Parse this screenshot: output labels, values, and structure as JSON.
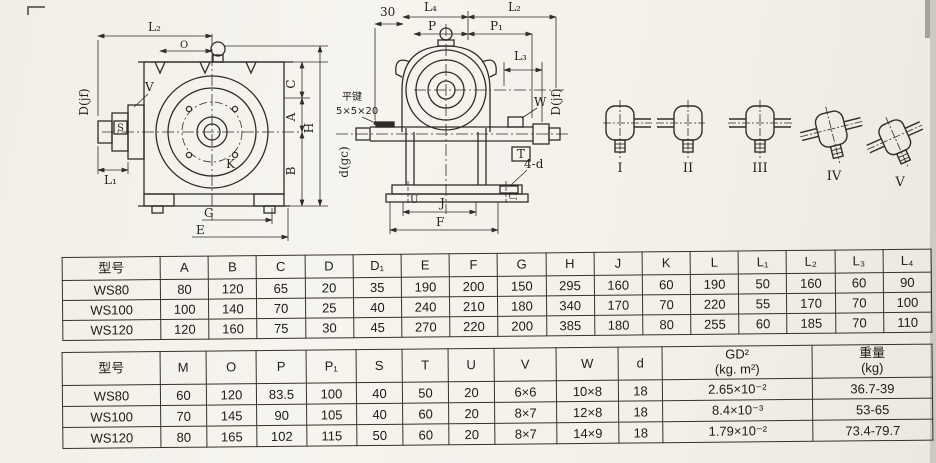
{
  "page": {
    "background": "#f4f2ec",
    "ink": "#2a2823"
  },
  "drawings": {
    "front_view": {
      "labels": {
        "L2": "L₂",
        "O": "O",
        "Djf": "D(jf)",
        "V": "V",
        "S": "S",
        "L1": "L₁",
        "K": "K",
        "C": "C",
        "A": "A",
        "B": "B",
        "H": "H",
        "G": "G",
        "E": "E"
      }
    },
    "side_view": {
      "labels": {
        "dim30": "30",
        "L4": "L₄",
        "L2": "L₂",
        "P": "P",
        "P1": "P₁",
        "L3": "L₃",
        "key_line1": "平键",
        "key_line2": "5×5×20",
        "dgc": "d(gc)",
        "W": "W",
        "Djf": "D(jf)",
        "T": "T",
        "four_d": "4-d",
        "U": "U",
        "J": "J",
        "F": "F"
      }
    },
    "shaft_arrangements": {
      "labels": [
        "I",
        "II",
        "III",
        "IV",
        "V"
      ]
    }
  },
  "tables": [
    {
      "columns": [
        "型号",
        "A",
        "B",
        "C",
        "D",
        "D₁",
        "E",
        "F",
        "G",
        "H",
        "J",
        "K",
        "L",
        "L₁",
        "L₂",
        "L₃",
        "L₄"
      ],
      "rows": [
        [
          "WS80",
          "80",
          "120",
          "65",
          "20",
          "35",
          "190",
          "200",
          "150",
          "295",
          "160",
          "60",
          "190",
          "50",
          "160",
          "60",
          "90"
        ],
        [
          "WS100",
          "100",
          "140",
          "70",
          "25",
          "40",
          "240",
          "210",
          "180",
          "340",
          "170",
          "70",
          "220",
          "55",
          "170",
          "70",
          "100"
        ],
        [
          "WS120",
          "120",
          "160",
          "75",
          "30",
          "45",
          "270",
          "220",
          "200",
          "385",
          "180",
          "80",
          "255",
          "60",
          "185",
          "70",
          "110"
        ]
      ]
    },
    {
      "columns": [
        "型号",
        "M",
        "O",
        "P",
        "P₁",
        "S",
        "T",
        "U",
        "V",
        "W",
        "d",
        "GD²\n(kg. m²)",
        "重量\n(kg)"
      ],
      "rows": [
        [
          "WS80",
          "60",
          "120",
          "83.5",
          "100",
          "40",
          "50",
          "20",
          "6×6",
          "10×8",
          "18",
          "2.65×10⁻²",
          "36.7-39"
        ],
        [
          "WS100",
          "70",
          "145",
          "90",
          "105",
          "40",
          "60",
          "20",
          "8×7",
          "12×8",
          "18",
          "8.4×10⁻³",
          "53-65"
        ],
        [
          "WS120",
          "80",
          "165",
          "102",
          "115",
          "50",
          "60",
          "20",
          "8×7",
          "14×9",
          "18",
          "1.79×10⁻²",
          "73.4-79.7"
        ]
      ]
    }
  ]
}
